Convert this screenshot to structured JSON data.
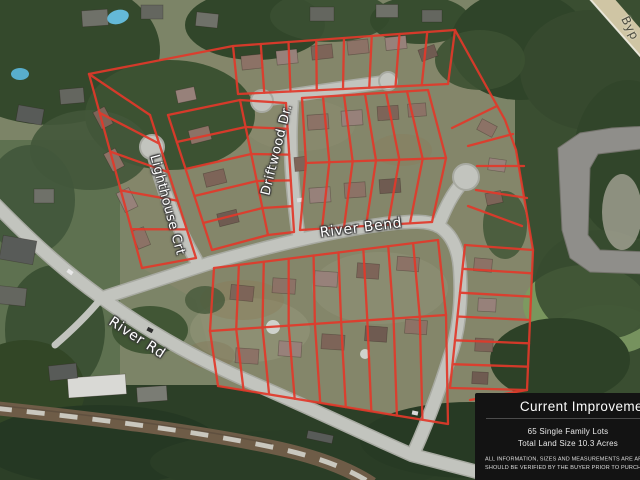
{
  "map": {
    "description": "Aerial satellite view of a subdivision with red lot outlines",
    "street_labels": [
      {
        "id": "lighthouse-crt",
        "text": "Lighthouse Crt"
      },
      {
        "id": "driftwood-dr",
        "text": "Driftwood Dr."
      },
      {
        "id": "river-bend",
        "text": "River Bend"
      },
      {
        "id": "river-rd",
        "text": "River Rd"
      },
      {
        "id": "bypass",
        "text": "Byp"
      }
    ],
    "lot_outline_color": "#e2392a",
    "road_color": "#c2c4be",
    "highway_color": "#cfc5a4"
  },
  "info_panel": {
    "title": "Current Improvements",
    "lines": [
      "65 Single Family Lots",
      "Total Land Size 10.3 Acres"
    ],
    "disclaimer": [
      "ALL INFORMATION, SIZES AND MEASUREMENTS ARE APPROXIMATE AND",
      "SHOULD BE VERIFIED BY THE BUYER PRIOR TO PURCHASE. *"
    ],
    "background": "#131313",
    "text_color": "#ffffff"
  }
}
